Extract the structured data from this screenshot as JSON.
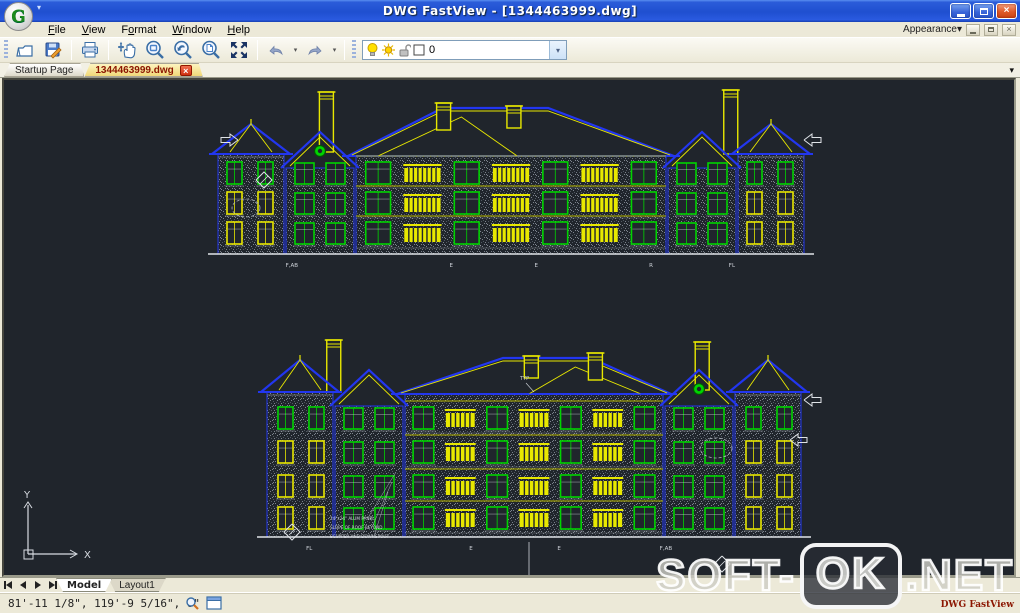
{
  "window": {
    "title": "DWG FastView - [1344463999.dwg]",
    "logo_letter": "G"
  },
  "menu": {
    "items": [
      {
        "pre": "",
        "u": "F",
        "post": "ile"
      },
      {
        "pre": "",
        "u": "V",
        "post": "iew"
      },
      {
        "pre": "F",
        "u": "o",
        "post": "rmat"
      },
      {
        "pre": "",
        "u": "W",
        "post": "indow"
      },
      {
        "pre": "",
        "u": "H",
        "post": "elp"
      }
    ],
    "appearance_label": "Appearance"
  },
  "toolbar": {
    "layer_value": "0"
  },
  "doc_tabs": {
    "startup": "Startup Page",
    "drawing": "1344463999.dwg",
    "close_glyph": "×"
  },
  "sheet_tabs": {
    "model": "Model",
    "layout1": "Layout1"
  },
  "status": {
    "coords": "81'-11 1/8\", 119'-9 5/16\", 0\"",
    "brand": "DWG FastView"
  },
  "watermark": {
    "part1": "SOFT-",
    "part2": "OK",
    "part3": ".NET"
  },
  "icons": {
    "dropdown": "▾",
    "close": "×"
  },
  "drawing": {
    "background": "#20252c",
    "colors": {
      "roof_blue": "#2236f0",
      "window_green": "#00d400",
      "accent_yellow": "#e8e800",
      "wall_dot": "#939aa4",
      "line_white": "#dfe3e8"
    },
    "ucs": {
      "x_label": "X",
      "y_label": "Y"
    },
    "elevations": [
      {
        "name": "rear-elevation",
        "grid_labels": [
          {
            "t": "F,AB",
            "f": 0.126
          },
          {
            "t": "E",
            "f": 0.398
          },
          {
            "t": "E",
            "f": 0.543
          },
          {
            "t": "R",
            "f": 0.739
          },
          {
            "t": "FL",
            "f": 0.877
          }
        ]
      },
      {
        "name": "front-elevation",
        "grid_labels": [
          {
            "t": "FL",
            "f": 0.079
          },
          {
            "t": "E",
            "f": 0.382
          },
          {
            "t": "E",
            "f": 0.547
          },
          {
            "t": "F,AB",
            "f": 0.747
          }
        ],
        "annotations": [
          "24\"x24\" ALUM PANEL",
          "SLOPE OF ROOF BEYOND",
          "SCUPPER AND DOWNSPOUT"
        ],
        "note": "TYP"
      }
    ]
  }
}
